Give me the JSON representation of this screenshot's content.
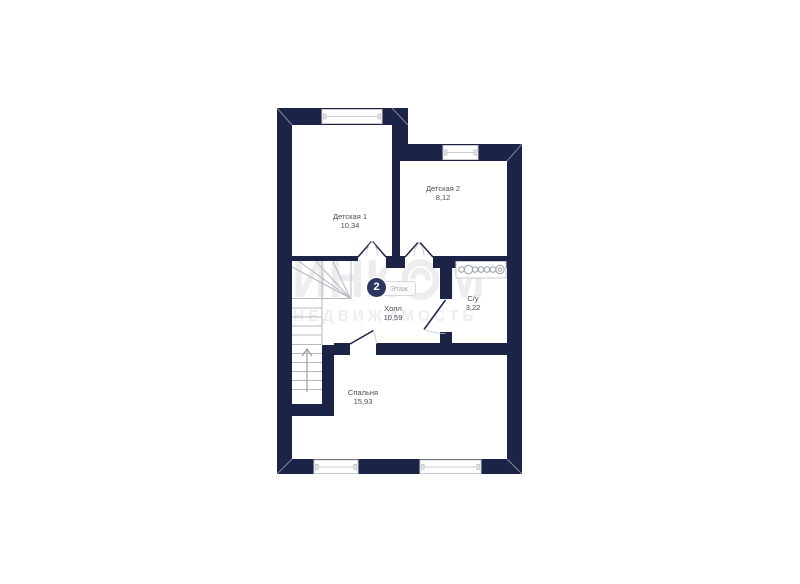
{
  "colors": {
    "wall": "#1b2347",
    "watermark": "#ededf0",
    "stair_lines": "#b6b9bf",
    "label_text": "#474c54",
    "badge_circle": "#2e3764"
  },
  "watermark": {
    "brand_prefix": "ИНК",
    "brand_suffix": "М",
    "logo": "incom-circle-logo",
    "subtitle": "НЕДВИЖИМОСТЬ"
  },
  "floor_badge": {
    "number": "2",
    "label": "Этаж"
  },
  "rooms": [
    {
      "name": "Детская 1",
      "area": "10,34"
    },
    {
      "name": "Детская 2",
      "area": "8,12"
    },
    {
      "name": "Холл",
      "area": "10,59"
    },
    {
      "name": "С/у",
      "area": "3,22"
    },
    {
      "name": "Спальня",
      "area": "15,93"
    }
  ]
}
